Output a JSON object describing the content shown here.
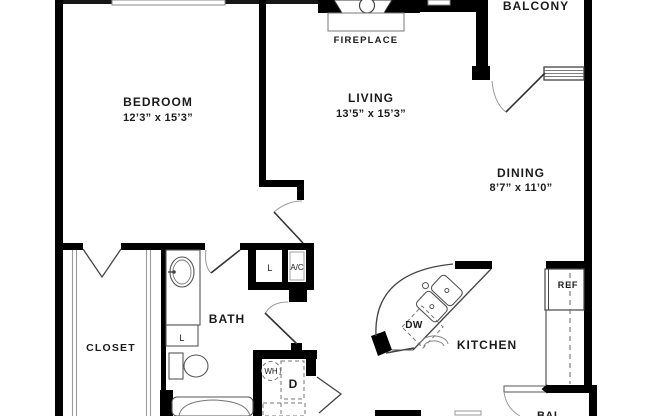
{
  "plan": {
    "type": "apartment-floor-plan",
    "colors": {
      "wall": "#000000",
      "background": "#ffffff",
      "thin_line": "#9a9a9a",
      "text": "#1b1b1b"
    }
  },
  "rooms": {
    "bedroom": {
      "label": "BEDROOM",
      "dims": "12’3” x 15’3”"
    },
    "living": {
      "label": "LIVING",
      "dims": "13’5” x 15’3”"
    },
    "dining": {
      "label": "DINING",
      "dims": "8’7” x 11’0”"
    },
    "balcony": {
      "label": "BALCONY"
    },
    "balcony_lower": {
      "label": "BAL"
    },
    "closet": {
      "label": "CLOSET"
    },
    "bath": {
      "label": "BATH"
    },
    "kitchen": {
      "label": "KITCHEN"
    }
  },
  "fixtures": {
    "fireplace": {
      "label": "FIREPLACE"
    },
    "refrigerator": {
      "label": "REF"
    },
    "dishwasher": {
      "label": "DW"
    },
    "water_heater": {
      "label": "WH"
    },
    "dryer": {
      "label": "D"
    },
    "ac_closet": {
      "label": "A/C"
    },
    "linen_hall": {
      "label": "L"
    },
    "linen_bath": {
      "label": "L"
    }
  }
}
